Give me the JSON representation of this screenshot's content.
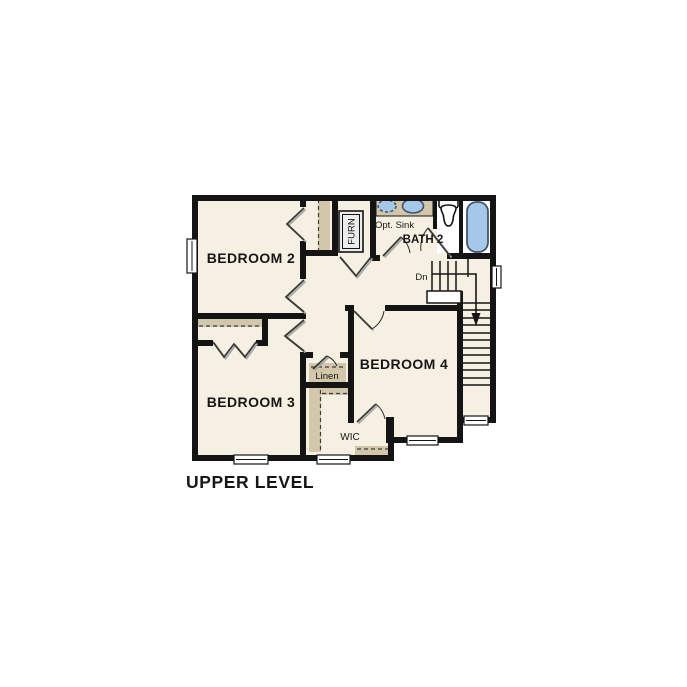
{
  "plan": {
    "title": "UPPER LEVEL",
    "level_name": "Upper Level floor plan"
  },
  "rooms": {
    "bedroom2": "BEDROOM 2",
    "bedroom3": "BEDROOM 3",
    "bedroom4": "BEDROOM 4",
    "bath2": "BATH 2",
    "wic": "WIC",
    "linen": "Linen",
    "furnace": "FURN"
  },
  "annotations": {
    "opt_sink": "Opt. Sink",
    "stairs_down": "Dn"
  },
  "colors": {
    "floor": "#f6f0e2",
    "wall": "#141414",
    "shelf_tan": "#d3c7ab",
    "fixture_blue": "#a6c8e8",
    "fixture_border": "#44536b",
    "niche_white": "#ffffff"
  }
}
